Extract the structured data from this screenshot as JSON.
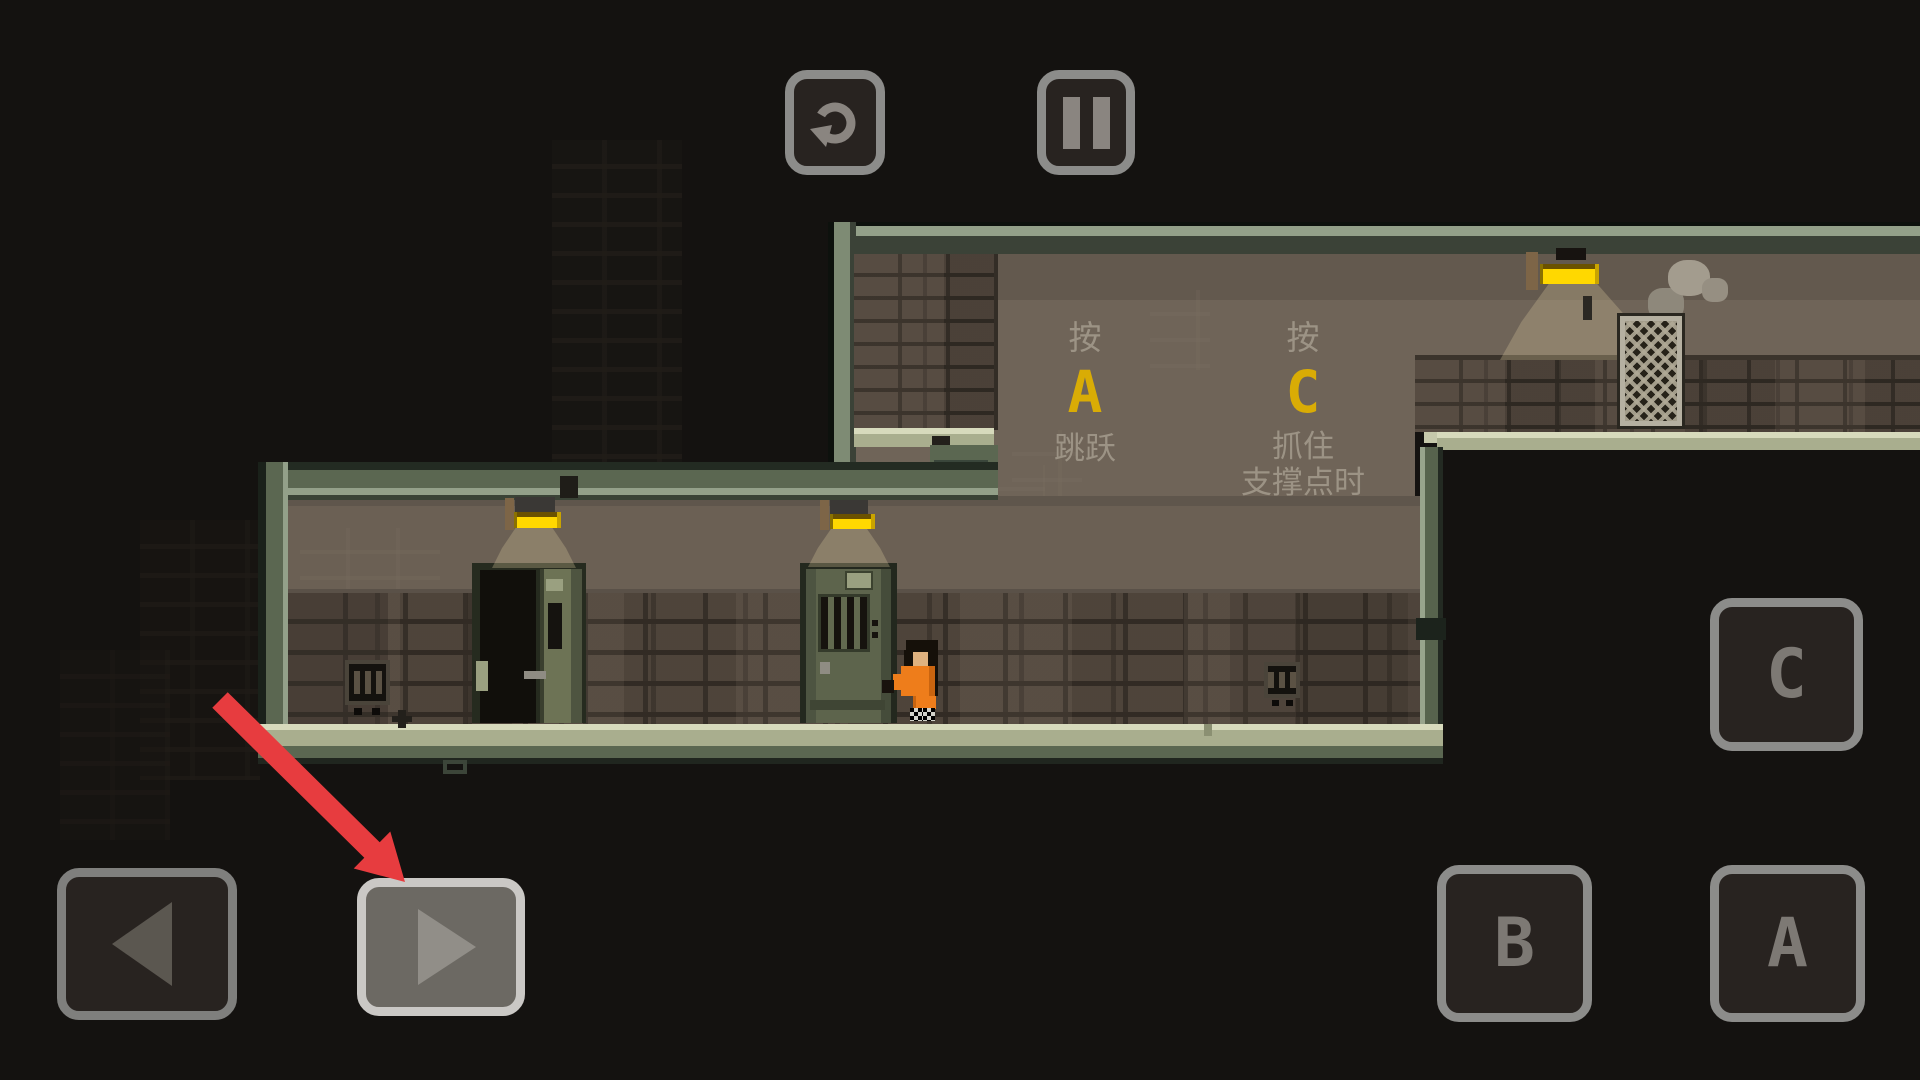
{
  "hud": {
    "restart_icon": "restart-circular-arrow",
    "pause_icon": "pause-two-bars",
    "move_left_glyph": "◀",
    "move_right_glyph": "▶",
    "action_buttons": {
      "a": "A",
      "b": "B",
      "c": "C"
    },
    "button_border_color": "#8c8c8a",
    "highlight_border_color": "#cac8c5"
  },
  "tutorial": {
    "jump": {
      "press": "按",
      "key": "A",
      "action": "跳跃"
    },
    "grab": {
      "press": "按",
      "key": "C",
      "lines": [
        "抓住",
        "支撑点时",
        "来释放"
      ]
    },
    "key_color": "#d9ac05",
    "text_color": "#a0978a"
  },
  "annotation": {
    "shape": "red-arrow",
    "color": "#e73c3f",
    "target": "move-right-button"
  },
  "scene": {
    "player": "prisoner-orange-jumpsuit",
    "lamp_color": "#ffd800",
    "objects": [
      "open-cell-door",
      "closed-cell-door",
      "ceiling-lamps",
      "wire-mesh-basket",
      "smoke-puffs",
      "wall-vents"
    ]
  }
}
